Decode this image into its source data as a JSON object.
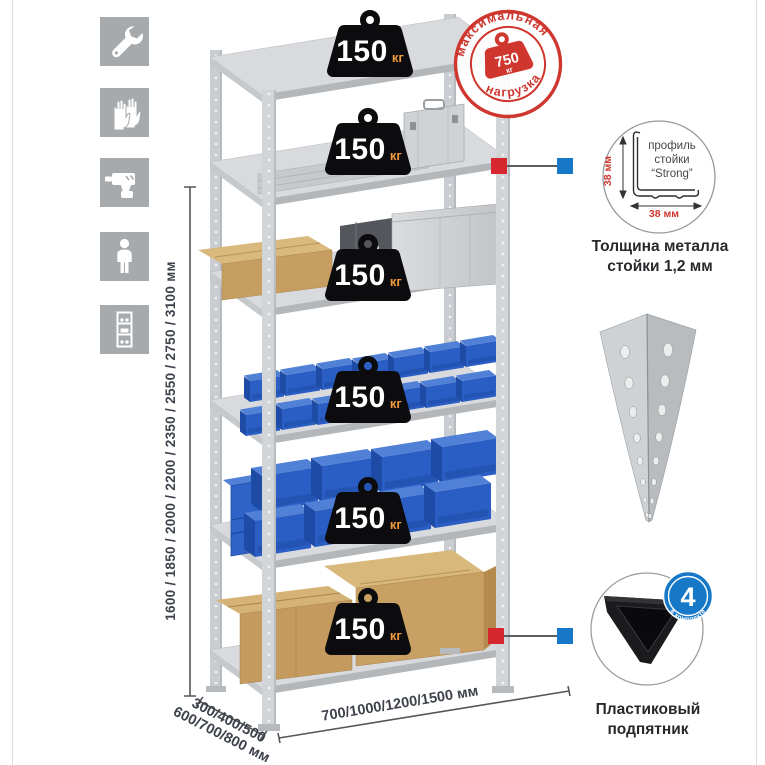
{
  "page": {
    "background": "#ffffff",
    "border_color": "#dfdfe2"
  },
  "sidebar": {
    "bg_color": "#a7aaad",
    "icons": [
      {
        "name": "wrench-icon"
      },
      {
        "name": "gloves-icon"
      },
      {
        "name": "drill-icon"
      },
      {
        "name": "person-icon"
      },
      {
        "name": "rack-icon"
      }
    ]
  },
  "dimensions": {
    "height": "1600 / 1850 / 2000 / 2200 / 2350 / 2550 / 2750 / 3100 мм",
    "depth_line1": "300/400/500",
    "depth_line2": "600/700/800 мм",
    "width": "700/1000/1200/1500 мм"
  },
  "max_load_stamp": {
    "arc_top": "максимальная",
    "arc_bottom": "нагрузка",
    "value": "750",
    "unit": "кг",
    "color": "#cf362e"
  },
  "shelves": [
    {
      "load": "150",
      "unit": "кг"
    },
    {
      "load": "150",
      "unit": "кг"
    },
    {
      "load": "150",
      "unit": "кг"
    },
    {
      "load": "150",
      "unit": "кг"
    },
    {
      "load": "150",
      "unit": "кг"
    },
    {
      "load": "150",
      "unit": "кг"
    }
  ],
  "profile_callout": {
    "line1": "профиль",
    "line2": "стойки",
    "line3": "“Strong”",
    "dim_vertical": "38 мм",
    "dim_horizontal": "38 мм",
    "caption_line1": "Толщина металла",
    "caption_line2": "стойки 1,2 мм"
  },
  "foot_callout": {
    "badge_value": "4",
    "badge_arc": "в комплекте",
    "caption_line1": "Пластиковый",
    "caption_line2": "подпятник"
  },
  "colors": {
    "accent_red": "#d7272e",
    "accent_blue": "#1878c8",
    "bin_blue": "#2b5ec4",
    "cardboard": "#c49a5e",
    "metal": "#d2d5d8"
  }
}
